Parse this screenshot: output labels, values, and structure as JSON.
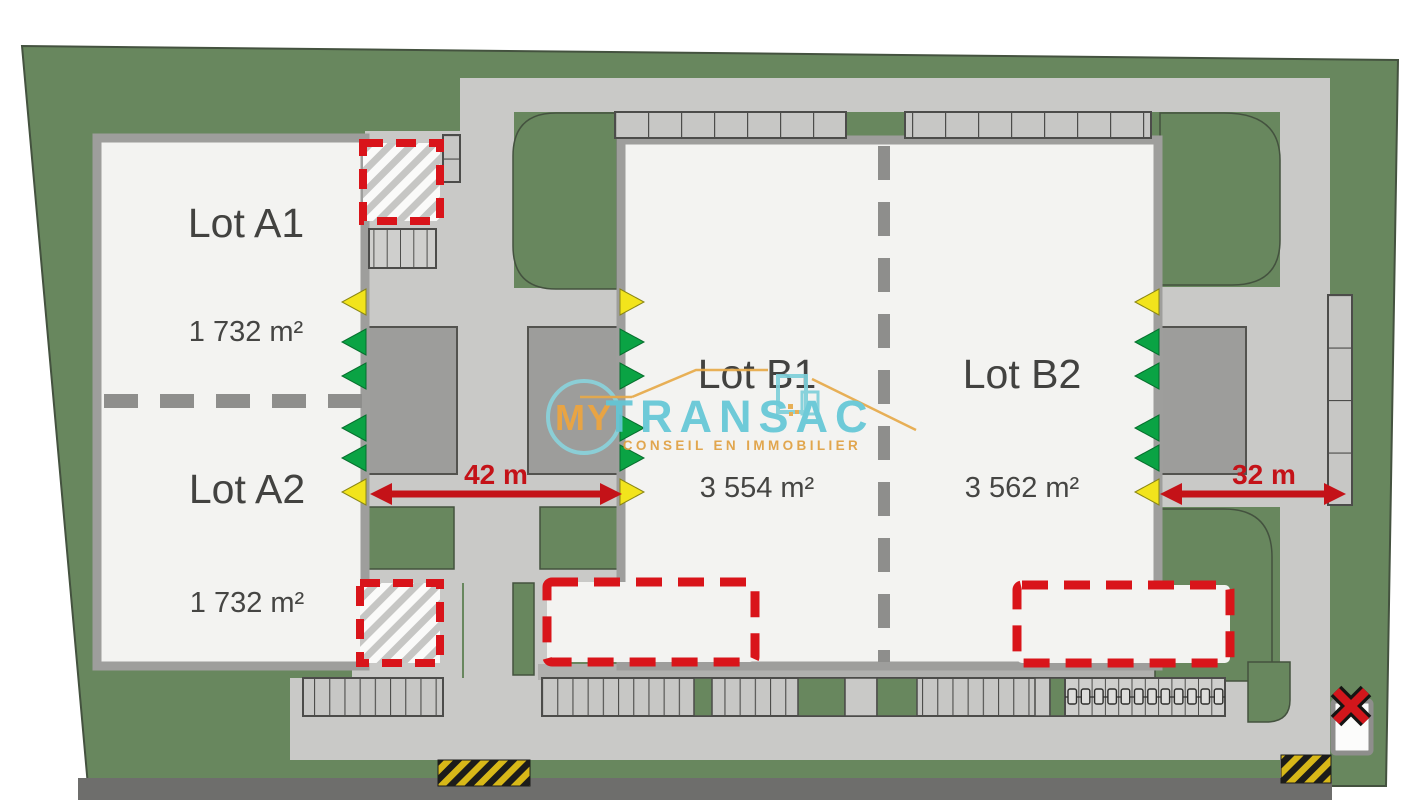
{
  "plan": {
    "title": "Site plan with lots",
    "lots": [
      {
        "id": "A1",
        "label": "Lot A1",
        "area": "1 732 m²"
      },
      {
        "id": "A2",
        "label": "Lot A2",
        "area": "1 732 m²"
      },
      {
        "id": "B1",
        "label": "Lot B1",
        "area": "3 554 m²"
      },
      {
        "id": "B2",
        "label": "Lot B2",
        "area": "3 562 m²"
      }
    ],
    "dimensions": [
      {
        "id": "courtyard-ab-width",
        "label": "42 m"
      },
      {
        "id": "courtyard-b2-width",
        "label": "32 m"
      }
    ]
  },
  "watermark": {
    "prefix": "MY",
    "brand": "TRANSAC",
    "tagline": "CONSEIL EN IMMOBILIER"
  },
  "colors": {
    "site_green": "#68875e",
    "road_gray": "#c9c9c7",
    "building_white": "#f3f3f1",
    "truck_court_gray": "#9d9d9b",
    "asphalt_dark": "#6e6e6c",
    "accent_red": "#c41218",
    "dock_green": "#0aa344",
    "dock_yellow": "#f2e41c",
    "brand_teal": "#63c7d6",
    "brand_orange": "#efa53d"
  }
}
